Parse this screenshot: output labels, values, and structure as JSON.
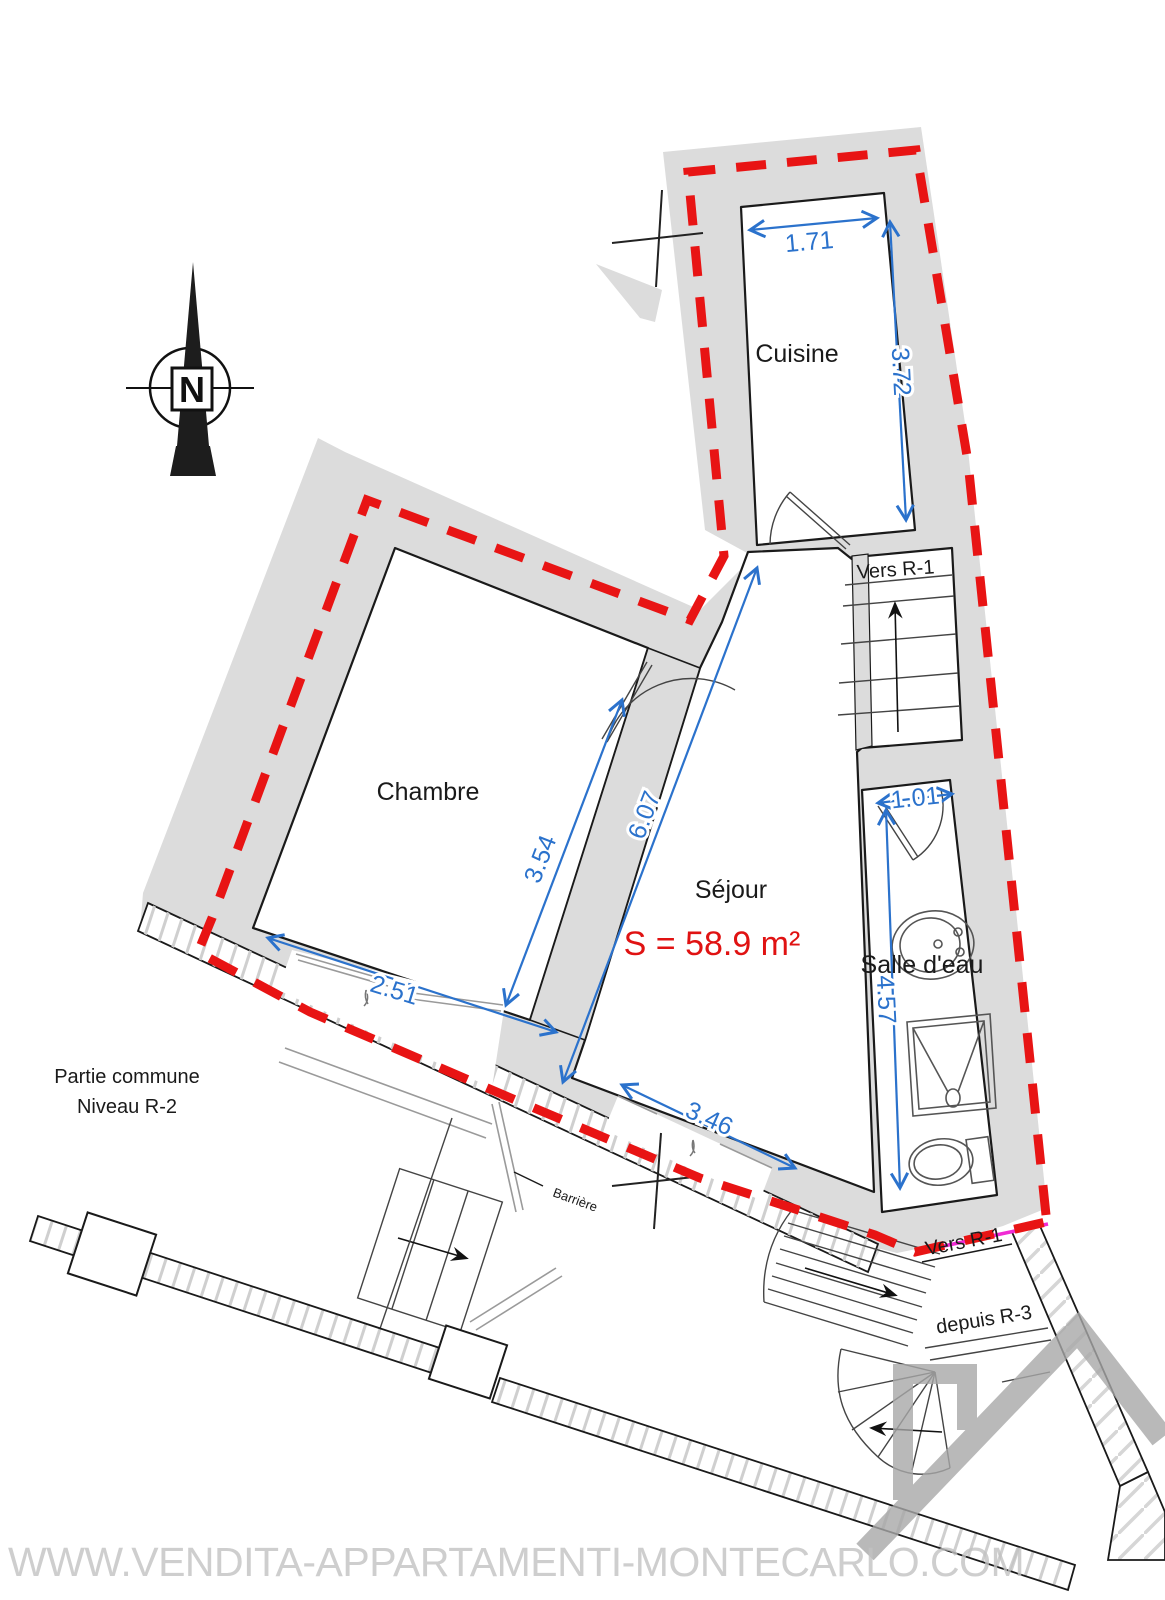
{
  "plan": {
    "title": "Apartment floor plan — Niveau R-2",
    "rooms": {
      "cuisine": "Cuisine",
      "chambre": "Chambre",
      "sejour": "Séjour",
      "salle_deau": "Salle d'eau"
    },
    "area": "S = 58.9 m²",
    "dims": {
      "cuisine_width": "1.71",
      "cuisine_depth": "3.72",
      "chambre_depth": "3.54",
      "sejour_diag": "6.07",
      "chambre_opening": "2.51",
      "bath_door": "1.01",
      "bath_depth": "4.57",
      "sejour_opening": "3.46"
    },
    "annotations": {
      "common1": "Partie commune",
      "common2": "Niveau R-2",
      "vers_r1_top": "Vers R-1",
      "vers_r1_bottom": "Vers R-1",
      "depuis_r3": "depuis R-3",
      "barriere": "Barrière",
      "north": "N"
    },
    "watermark": "WWW.VENDITA-APPARTAMENTI-MONTECARLO.COM",
    "colors": {
      "boundary_red": "#e81414",
      "dimension_blue": "#2b72cc",
      "area_red": "#e01212",
      "wall_gray": "#dcdcdc",
      "watermark_gray": "#c2c2c2",
      "logo_gray": "#a8a8a8",
      "magenta": "#f02bd4"
    }
  }
}
